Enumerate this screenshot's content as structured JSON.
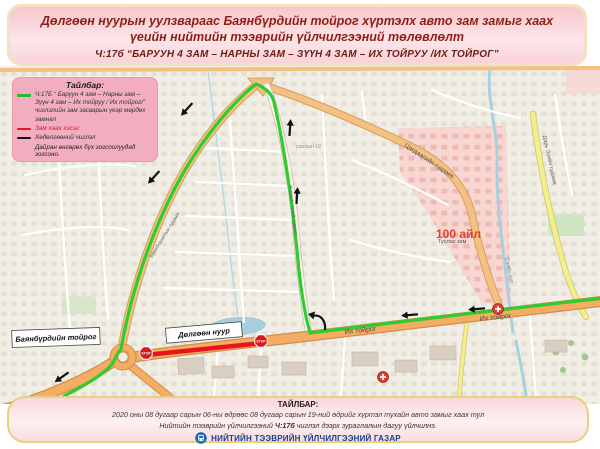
{
  "header": {
    "title": "Дөлгөөн нуурын уулзвараас Баянбүрдийн тойрог хүртэлх авто зам замыг хаах үеийн нийтийн тээврийн үйлчилгээний төлөвлөлт",
    "subtitle": "Ч:17б “БАРУУН 4 ЗАМ – НАРНЫ ЗАМ – ЗҮҮН 4 ЗАМ – ИХ ТОЙРУУ /ИХ ТОЙРОГ”"
  },
  "legend": {
    "title": "Тайлбар:",
    "route_item": "Ч:17Б “ Баруун 4 зам – Нарны зам – Зүүн 4 зам – Их тойруу / Их тойрог/” чиглэлийн зам засварын үеэр мөрдөх замнал",
    "closed_item": "Зам хаах хэсэг",
    "direction_item": "Хөдөлгөөний чиглэл",
    "note": "Дайран өнгөрөх бүх зогсоолуудад зогсоно.",
    "colors": {
      "route": "#2eb82e",
      "closed": "#e8141c",
      "direction": "#111111"
    },
    "swatch_styles": {
      "route": "background:#2eb82e",
      "closed": "background:#e8141c",
      "direction": "background:#111111"
    }
  },
  "map": {
    "stop_label": "STOP",
    "labels": {
      "bayanburd": "Баянбүрдийн тойрог",
      "dolgoon_lake": "Дөлгөөн нуур",
      "ih_toirog_w": "Их тойрог",
      "ih_toirog_e": "Их тойрог",
      "tsagdaa_st": "Цагдаагийн гудамж",
      "ail_100": "100 айл",
      "tuslah": "Туслах зам",
      "selbe": "Сэлбэ гол",
      "dari_eh": "Дарь Эхийн гудамж",
      "jamyan_gun": "Жамьян гүний гудамж",
      "bayanboshigt": "Баянбошигтын гудамж",
      "rashaan": "рашаан 18"
    }
  },
  "footer": {
    "title": "ТАЙЛБАР:",
    "line1": "2020 оны 08 дугаар сарын 06-ны өдрөөс 08 дугаар сарын 19-ний өдрийг хүртэл тухайн авто замыг хаах тул",
    "line2_prefix": "Нийтийн тээврийн үйлчилгээний ",
    "line2_route": "Ч:17б",
    "line2_suffix": " чиглэл дээрх зураглалын дагуу үйлчилнэ.",
    "agency": "НИЙТИЙН ТЭЭВРИЙН ҮЙЛЧИЛГЭЭНИЙ ГАЗАР"
  }
}
